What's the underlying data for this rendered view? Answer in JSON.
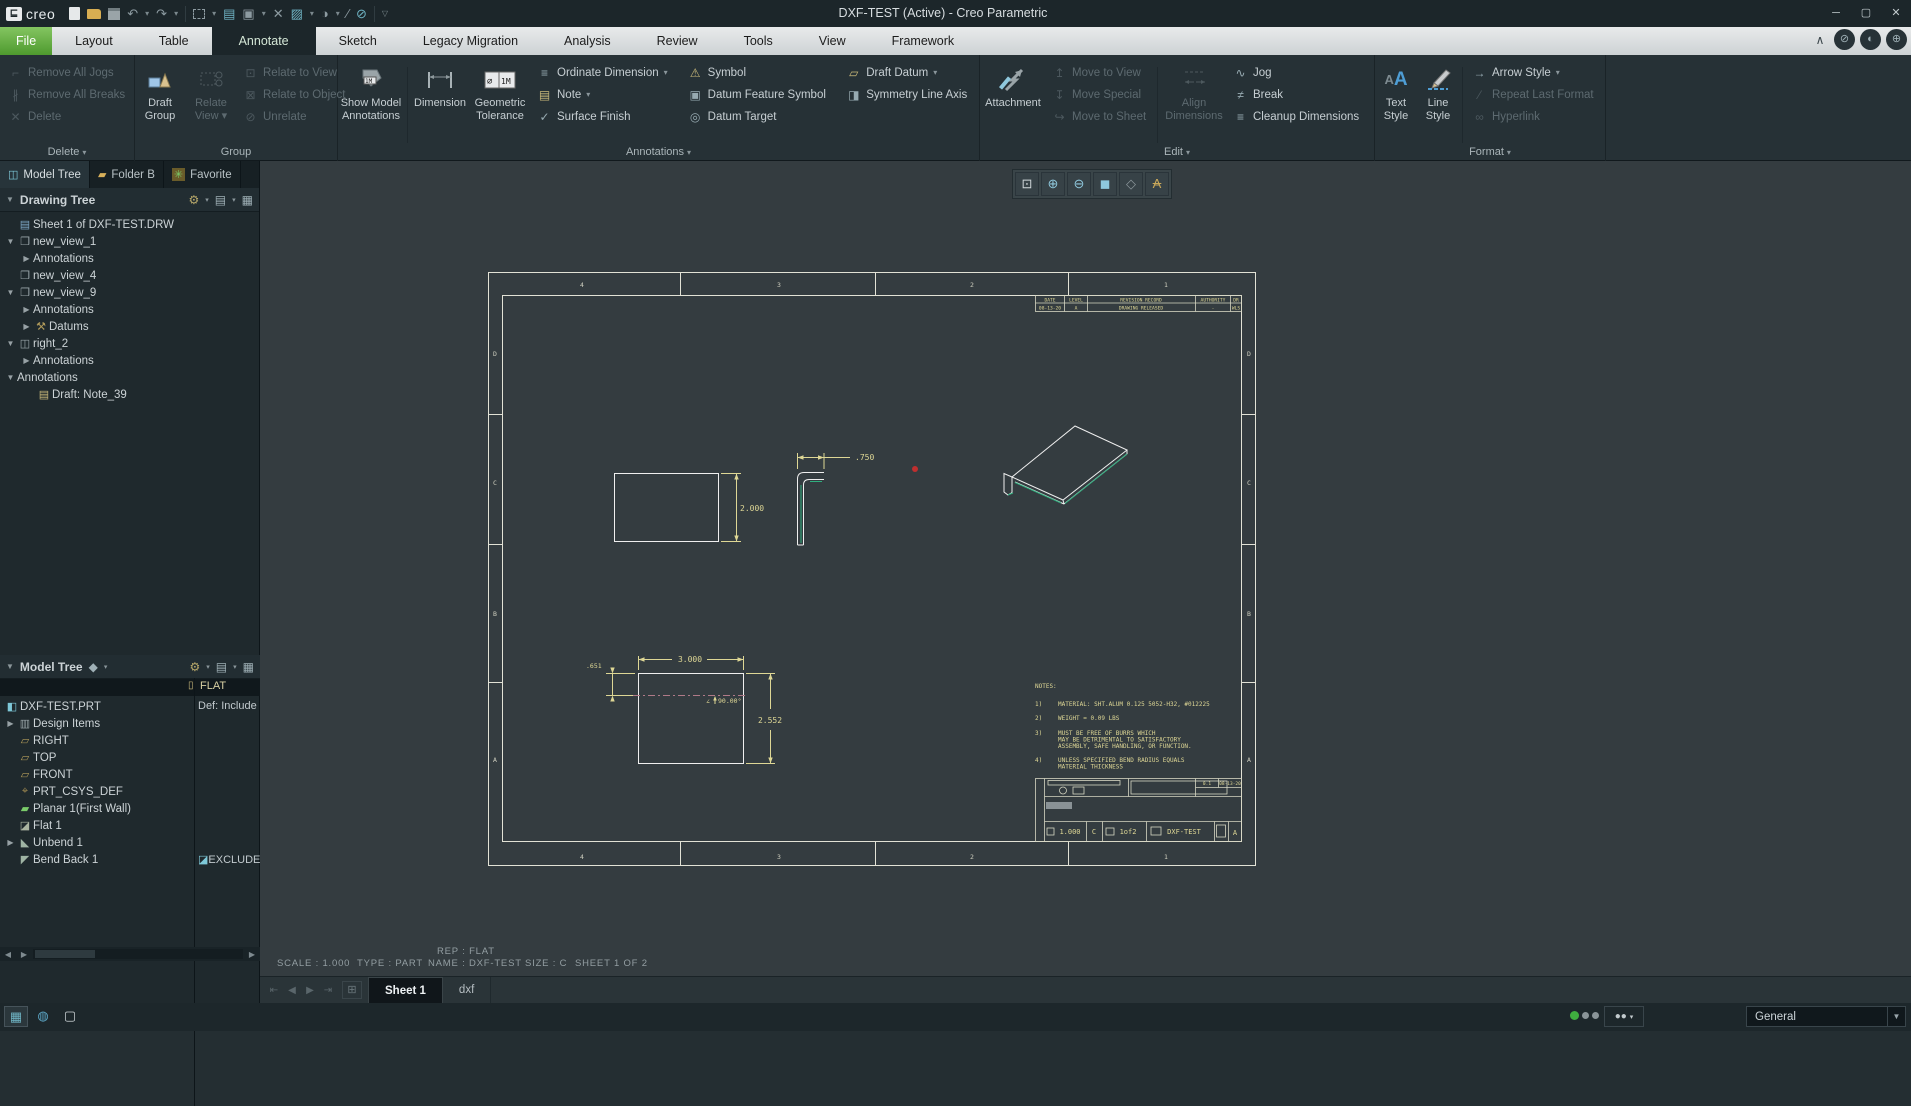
{
  "titlebar": {
    "brand": "creo",
    "title": "DXF-TEST (Active) - Creo Parametric"
  },
  "icons": {
    "minimize": "─",
    "maximize": "▢",
    "close": "✕",
    "refit": "⊡",
    "zoom_in": "⊕",
    "zoom_out": "⊖",
    "display_style": "◼",
    "datum_display": "◇",
    "annotation_display": "A",
    "nav_first": "⇤",
    "nav_prev": "◀",
    "nav_next": "▶",
    "nav_last": "⇥",
    "add_sheet": "⊞",
    "panel_toggle": "▦",
    "browser": "◍",
    "window": "▢",
    "collapse_ribbon": "∧",
    "search": "⊘",
    "sync": "◐",
    "account": "⊕"
  },
  "tabbar": {
    "tabs": [
      "File",
      "Layout",
      "Table",
      "Annotate",
      "Sketch",
      "Legacy Migration",
      "Analysis",
      "Review",
      "Tools",
      "View",
      "Framework"
    ]
  },
  "ribbon": {
    "delete_group": {
      "label": "Delete",
      "items": [
        "Remove All Jogs",
        "Remove All Breaks",
        "Delete"
      ]
    },
    "group_group": {
      "label": "Group",
      "big1": "Draft Group",
      "big2": "Relate View",
      "items": [
        "Relate to View",
        "Relate to Object",
        "Unrelate"
      ]
    },
    "annotations_group": {
      "label": "Annotations",
      "big1": "Show Model Annotations",
      "big2": "Dimension",
      "big3": "Geometric Tolerance",
      "col1": [
        "Ordinate Dimension",
        "Note",
        "Surface Finish"
      ],
      "col2": [
        "Symbol",
        "Datum Feature Symbol",
        "Datum Target"
      ],
      "col3": [
        "Draft Datum",
        "Symmetry Line Axis"
      ]
    },
    "edit_group": {
      "label": "Edit",
      "big1": "Attachment",
      "big2": "Align Dimensions",
      "col1": [
        "Move to View",
        "Move Special",
        "Move to Sheet"
      ],
      "col2": [
        "Jog",
        "Break",
        "Cleanup Dimensions"
      ]
    },
    "format_group": {
      "label": "Format",
      "big1": "Text Style",
      "big2": "Line Style",
      "items": [
        "Arrow Style",
        "Repeat Last Format",
        "Hyperlink"
      ]
    }
  },
  "left_panel": {
    "tabs": [
      "Model Tree",
      "Folder B",
      "Favorite"
    ],
    "drawing_tree": {
      "title": "Drawing Tree",
      "items": [
        "Sheet 1 of DXF-TEST.DRW",
        "new_view_1",
        "Annotations",
        "new_view_4",
        "new_view_9",
        "Annotations",
        "Datums",
        "right_2",
        "Annotations",
        "Annotations",
        "Draft: Note_39"
      ]
    },
    "model_tree": {
      "title": "Model Tree",
      "col_header": "FLAT",
      "items": [
        "DXF-TEST.PRT",
        "Design Items",
        "RIGHT",
        "TOP",
        "FRONT",
        "PRT_CSYS_DEF",
        "Planar 1(First Wall)",
        "Flat 1",
        "Unbend 1",
        "Bend Back 1"
      ],
      "root_value": "Def: Include",
      "bend_value": "EXCLUDE"
    }
  },
  "drawing": {
    "zones_h": [
      "4",
      "3",
      "2",
      "1"
    ],
    "zones_v": [
      "D",
      "C",
      "B",
      "A"
    ],
    "dims": {
      "rect_height": "2.000",
      "flange": ".750",
      "flat_width": "3.000",
      "flat_height": "2.552",
      "bend_offset": ".651",
      "bend_angle": "90.00°",
      "angle_mark": "∠"
    },
    "notes": {
      "header": "NOTES:",
      "n1": "1)",
      "t1": "MATERIAL: SHT.ALUM 0.125 5052-H32, #012225",
      "n2": "2)",
      "t2": "WEIGHT = 0.09 LBS",
      "n3": "3)",
      "t3a": "MUST BE FREE OF BURRS WHICH",
      "t3b": "MAY BE DETRIMENTAL TO SATISFACTORY",
      "t3c": "ASSEMBLY, SAFE HANDLING, OR FUNCTION.",
      "n4": "4)",
      "t4a": "UNLESS SPECIFIED BEND RADIUS EQUALS",
      "t4b": "MATERIAL THICKNESS"
    },
    "revision": {
      "h1": "DATE",
      "h2": "LEVEL",
      "h3": "REVISION RECORD",
      "h4": "AUTHORITY",
      "h5": "DR",
      "r1": "08-13-20",
      "r2": "A",
      "r3": "DRAWING RELEASED",
      "r4": "-",
      "r5": "WLS"
    },
    "titleblock": {
      "scale": "1.000",
      "size": "C",
      "sheet": "1of2",
      "name": "DXF-TEST",
      "rev": "A",
      "f1": "0.1",
      "date": "08-13-20"
    }
  },
  "statusbar": {
    "rep": "REP : FLAT",
    "items": [
      "SCALE : 1.000",
      "TYPE : PART",
      "NAME : DXF-TEST",
      "SIZE : C",
      "SHEET 1  OF 2"
    ]
  },
  "sheet_tabs": {
    "tabs": [
      "Sheet 1",
      "dxf"
    ]
  },
  "bottom_bar": {
    "filter_label": "General"
  }
}
